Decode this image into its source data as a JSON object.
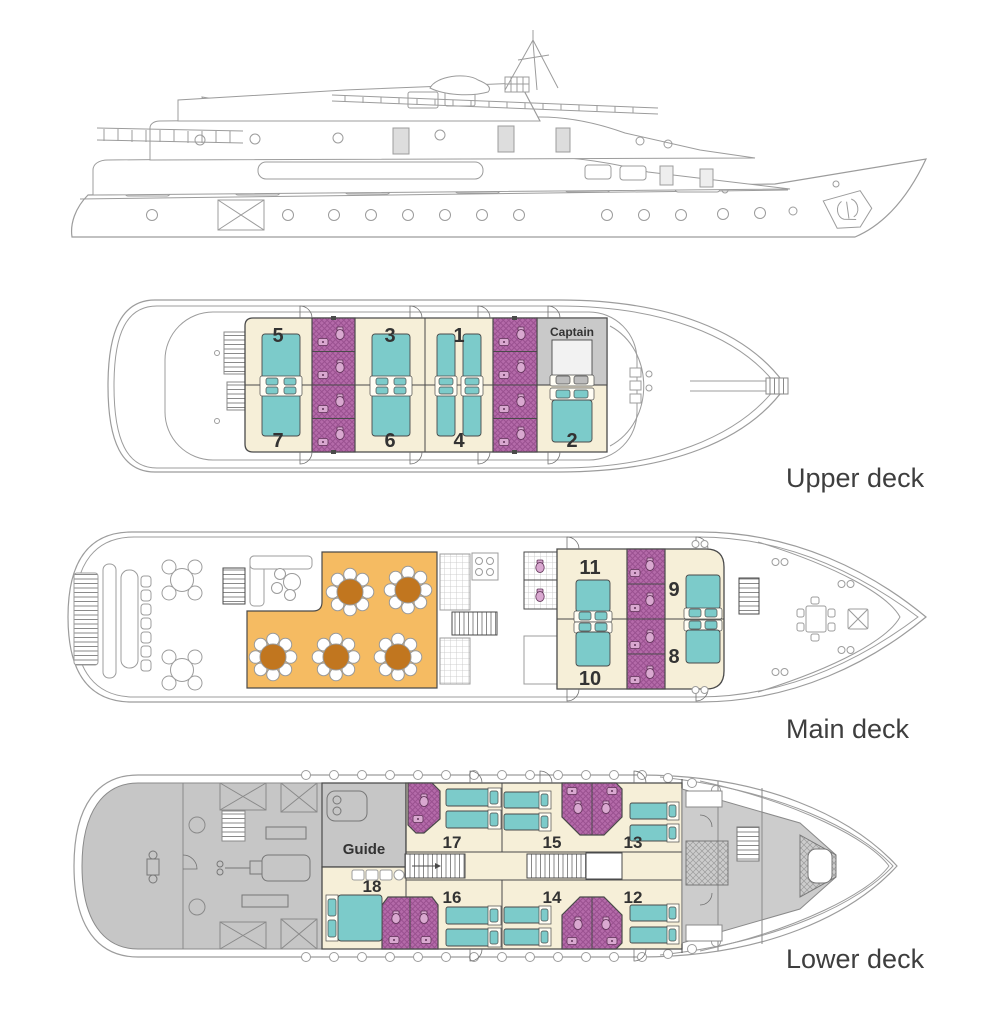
{
  "palette": {
    "cabin_floor": "#F6EFD8",
    "bed_teal": "#7CCBCA",
    "bathroom_purple": "#B46AA9",
    "dining_orange": "#F5BB62",
    "table_brown": "#C1761F",
    "captain_gray": "#C9C9C9",
    "crew_gray": "#C6C6C6",
    "outline_dark": "#4A4A4A",
    "outline_light": "#9C9C9C",
    "label_text": "#3E3E3E"
  },
  "icons": {
    "bow_emblem": "anchor-crest"
  },
  "decks": [
    {
      "name": "upper",
      "label": "Upper deck",
      "cabins": [
        {
          "n": "5"
        },
        {
          "n": "3"
        },
        {
          "n": "1"
        },
        {
          "n": "Captain"
        },
        {
          "n": "7"
        },
        {
          "n": "6"
        },
        {
          "n": "4"
        },
        {
          "n": "2"
        }
      ]
    },
    {
      "name": "main",
      "label": "Main deck",
      "cabins": [
        {
          "n": "11"
        },
        {
          "n": "9"
        },
        {
          "n": "10"
        },
        {
          "n": "8"
        }
      ]
    },
    {
      "name": "lower",
      "label": "Lower deck",
      "crew_label": "Guide",
      "cabins": [
        {
          "n": "17"
        },
        {
          "n": "15"
        },
        {
          "n": "13"
        },
        {
          "n": "18"
        },
        {
          "n": "16"
        },
        {
          "n": "14"
        },
        {
          "n": "12"
        }
      ]
    }
  ]
}
